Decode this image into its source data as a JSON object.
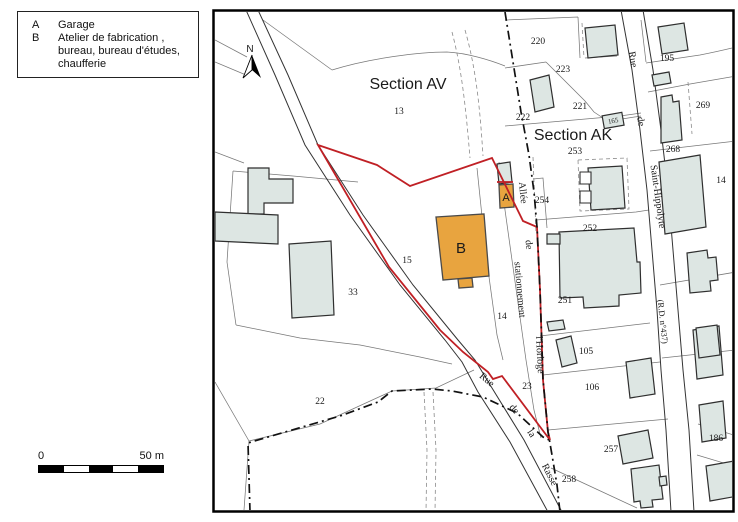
{
  "legend": {
    "items": [
      {
        "key": "A",
        "label": "Garage"
      },
      {
        "key": "B",
        "label": "Atelier de fabrication , bureau, bureau d'études, chaufferie"
      }
    ]
  },
  "scalebar": {
    "zero": "0",
    "fifty": "50 m"
  },
  "north": {
    "label": "N"
  },
  "sections": {
    "av": "Section AV",
    "ak": "Section AK"
  },
  "streets": {
    "rue1": "Rue",
    "de1": "de",
    "saint_hippolyte": "Saint-Hippolyte",
    "rd437": "(R.D. n°437)",
    "allee": "Allée",
    "de2": "de",
    "stationnement": "stationnement",
    "horloge": "l'Horloge",
    "rue2": "Rue",
    "de3": "de",
    "la": "la",
    "rasse": "Rasse"
  },
  "buildings": {
    "a": "A",
    "b": "B"
  },
  "parcels": {
    "p13": "13",
    "p15": "15",
    "p33": "33",
    "p14": "14",
    "p22": "22",
    "p23": "23",
    "p220": "220",
    "p223": "223",
    "p221": "221",
    "p222": "222",
    "p253": "253",
    "p254": "254",
    "p252": "252",
    "p251": "251",
    "p105": "105",
    "p106": "106",
    "p257": "257",
    "p258": "258",
    "p195": "195",
    "p269": "269",
    "p268": "268",
    "p165": "165",
    "p186": "186",
    "p14r": "14"
  },
  "colors": {
    "site_boundary": "#c02025",
    "building_highlight": "#e8a43f",
    "building_fill": "#dde6e3",
    "road_line": "#333333",
    "parcel_line": "#777777",
    "boundary_line": "#111111"
  }
}
